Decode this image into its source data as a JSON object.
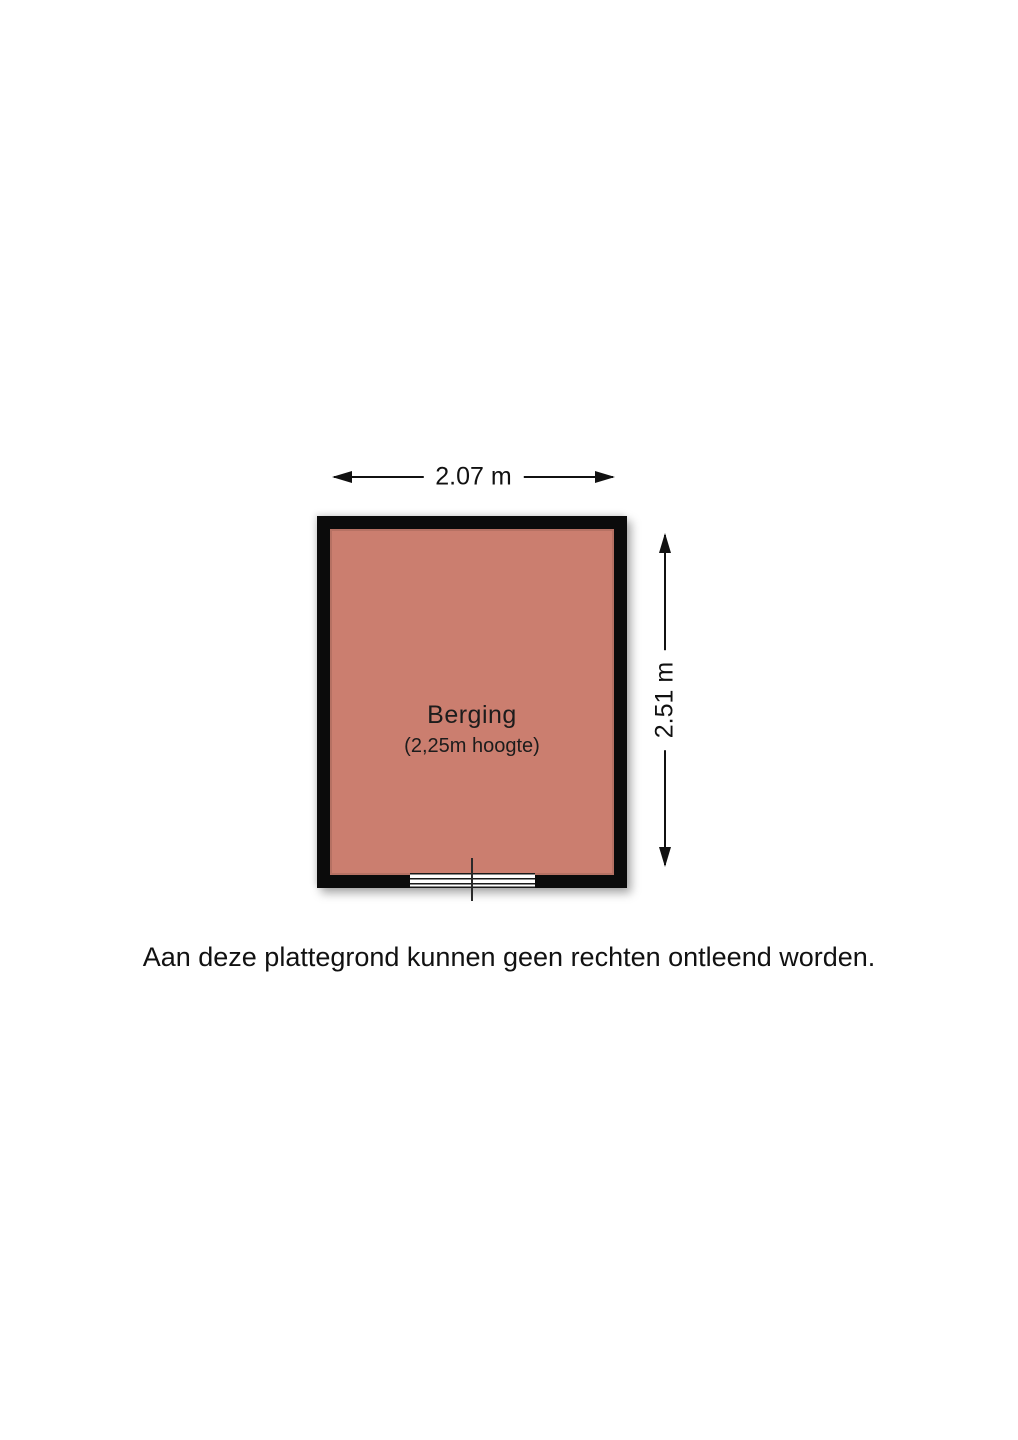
{
  "floorplan": {
    "room": {
      "label": "Berging",
      "sublabel": "(2,25m hoogte)",
      "fill_color": "#cb7e6f",
      "wall_color": "#0b0b0b"
    },
    "dimensions": {
      "width_label": "2.07 m",
      "height_label": "2.51 m"
    }
  },
  "disclaimer": "Aan deze plattegrond kunnen geen rechten ontleend worden."
}
